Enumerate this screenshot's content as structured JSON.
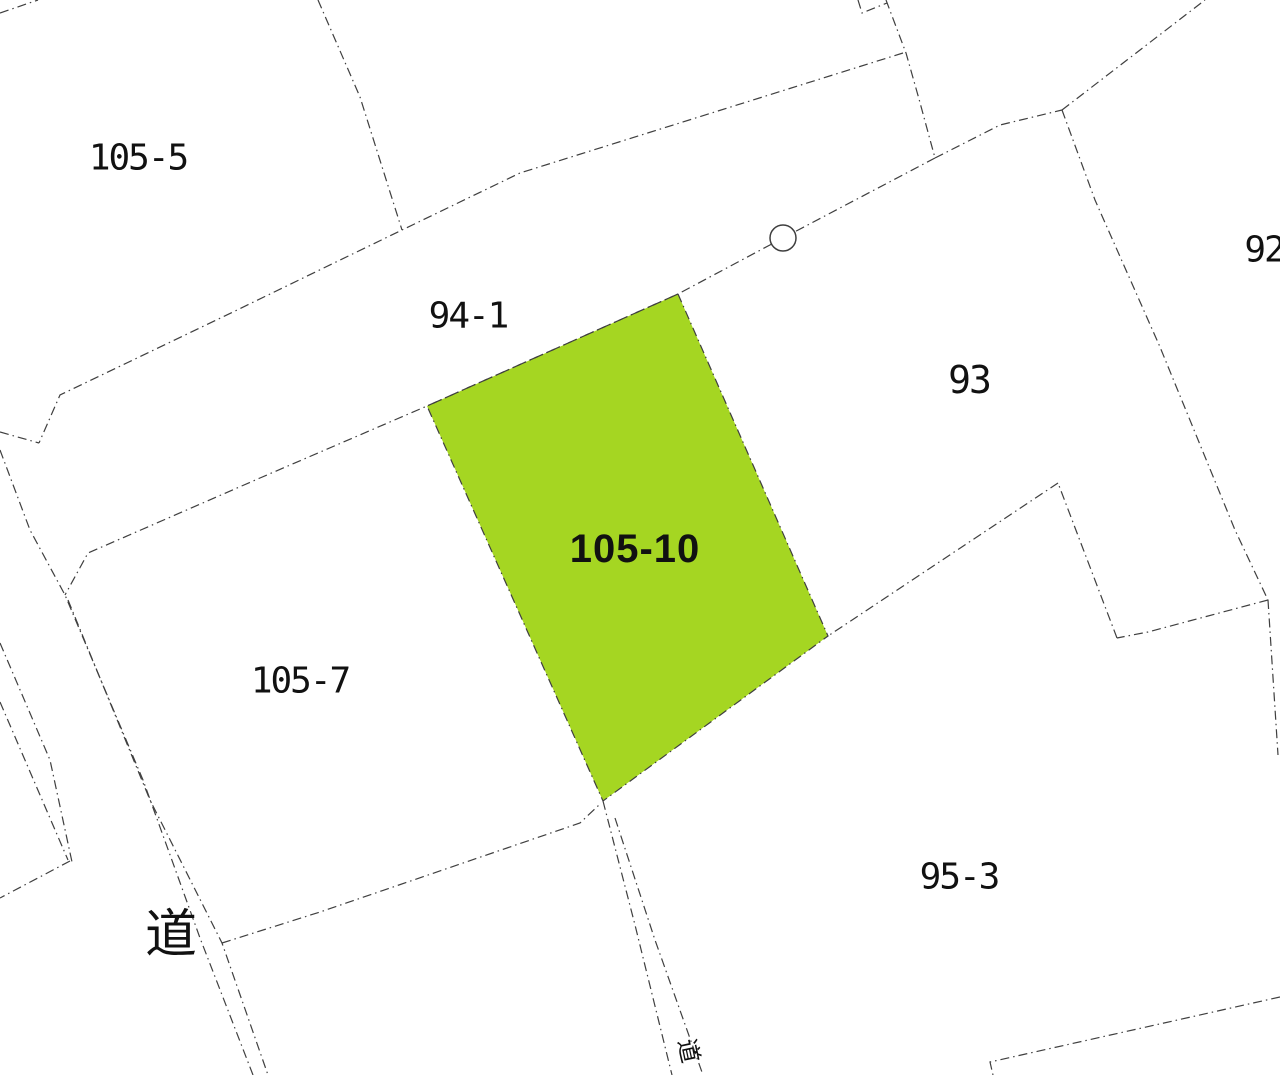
{
  "colors": {
    "background": "#ffffff",
    "boundary_line": "#3f3f3f",
    "highlight_fill": "#a5d622",
    "label_text": "#111111"
  },
  "parcels": {
    "p105_5": {
      "label": "105-5"
    },
    "p94_1": {
      "label": "94-1"
    },
    "p105_10": {
      "label": "105-10",
      "highlighted": "true"
    },
    "p105_7": {
      "label": "105-7"
    },
    "p93": {
      "label": "93"
    },
    "p92": {
      "label": "92"
    },
    "p95_3": {
      "label": "95-3"
    },
    "road_main": {
      "label": "道"
    },
    "road_small": {
      "label": "道"
    }
  },
  "markers": {
    "survey_point": {
      "shape": "circle"
    }
  }
}
